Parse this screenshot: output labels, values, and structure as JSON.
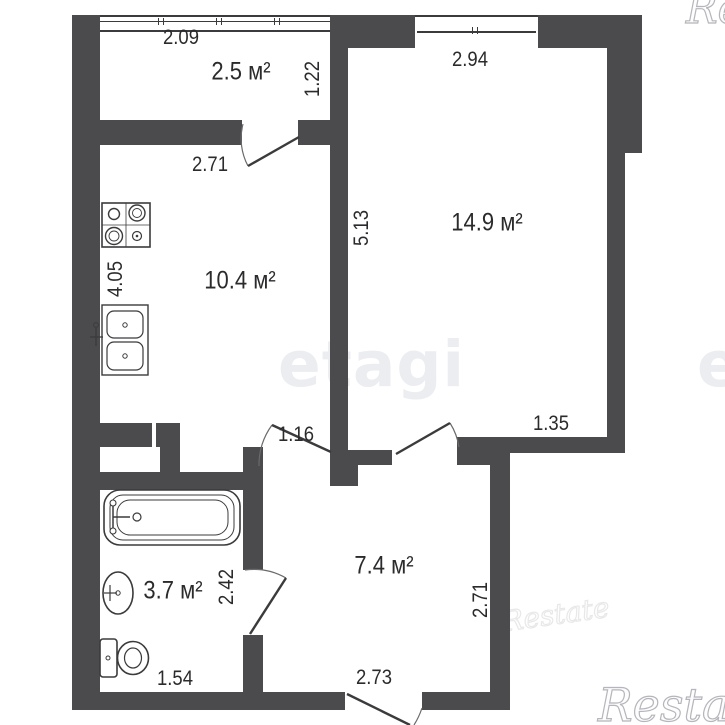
{
  "rooms": {
    "balcony": {
      "area": "2.5 м²"
    },
    "kitchen": {
      "area": "10.4 м²"
    },
    "living_room": {
      "area": "14.9 м²"
    },
    "hallway": {
      "area": "7.4 м²"
    },
    "bathroom": {
      "area": "3.7 м²"
    }
  },
  "dimensions_m": {
    "balcony_width": "2.09",
    "balcony_depth": "1.22",
    "kitchen_width": "2.71",
    "kitchen_depth": "4.05",
    "living_width": "2.94",
    "living_depth": "5.13",
    "living_inner": "1.35",
    "hall_opening": "1.16",
    "hall_depth": "2.71",
    "hall_width": "2.73",
    "bathroom_depth": "2.42",
    "bathroom_width": "1.54"
  },
  "watermarks": {
    "brand_center": "etagi",
    "brand_center_right": "etagi",
    "brand_corner": "Restate",
    "brand_corner_top": "Restate",
    "brand_mid": "Restate"
  },
  "icons": {
    "stove": "stove-icon",
    "kitchen_sink": "kitchen-sink-icon",
    "bathtub": "bathtub-icon",
    "washbasin": "washbasin-icon",
    "toilet": "toilet-icon"
  },
  "colors": {
    "wall": "#4b4b4d",
    "text": "#2b2b2d",
    "watermark_center": "#ebedf1",
    "watermark_outline": "#b5b5bb"
  }
}
